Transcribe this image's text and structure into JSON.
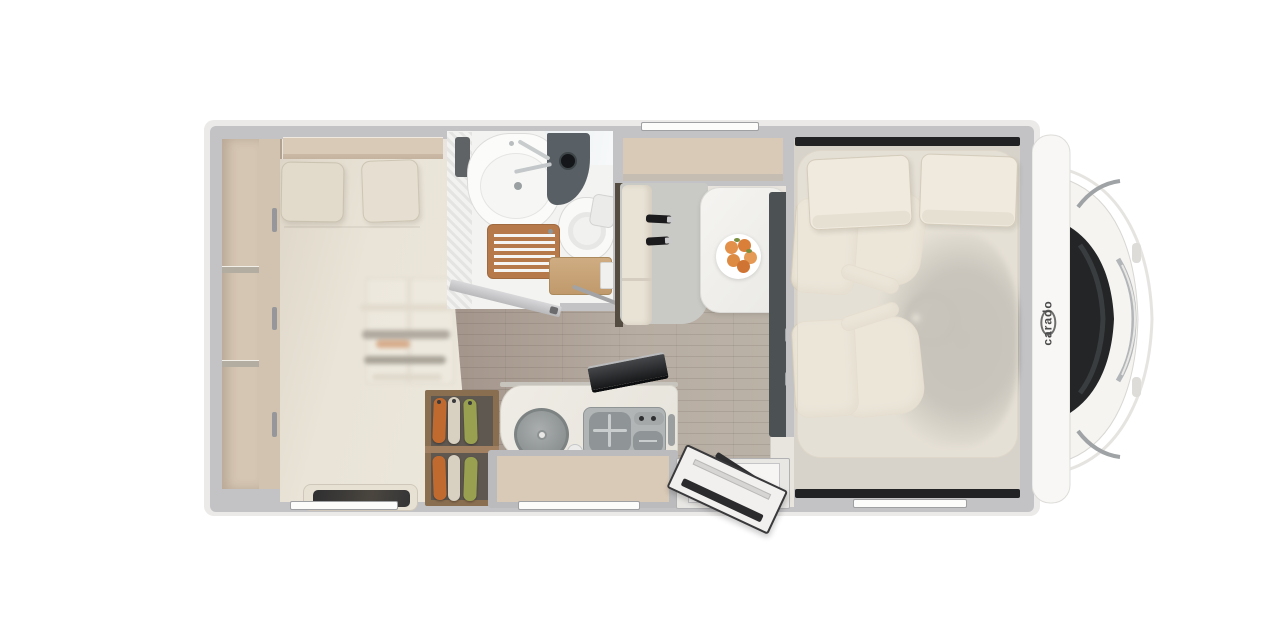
{
  "logo": {
    "text": "carado"
  },
  "palette": {
    "wall": "#c3c3c5",
    "trim": "#eceae8",
    "interior": "#e9e5de",
    "beige": "#d9c9b7",
    "beigeFront": "#d2c3b1",
    "bedCream": "#eae4d8",
    "pillowCream": "#e2dbcc",
    "woodA": "#a3948a",
    "woodB": "#b7ada2",
    "bathFloor": "#f3f3f1",
    "grate": "#b5794a",
    "vanity": "#c9a57b",
    "panel": "#4c5154",
    "bench": "#c9c9c5",
    "cushion": "#e9e3d6",
    "tableTop": "#f3f2ef",
    "counter": "#edeae3",
    "steel": "#b1b5b6",
    "steelDeep": "#8f9496",
    "belt": "#1b1b1d",
    "windshield": "#232527",
    "clothesOrange": "#c06a30",
    "clothesCream": "#d8d1c2",
    "clothesOlive": "#99a04f",
    "woodFrame": "#8a6e50",
    "leaf": "#7a8f3f",
    "cabFloor": "#d7d3ca",
    "window": "#fcfcfb",
    "logoText": "#4a4a4a"
  }
}
